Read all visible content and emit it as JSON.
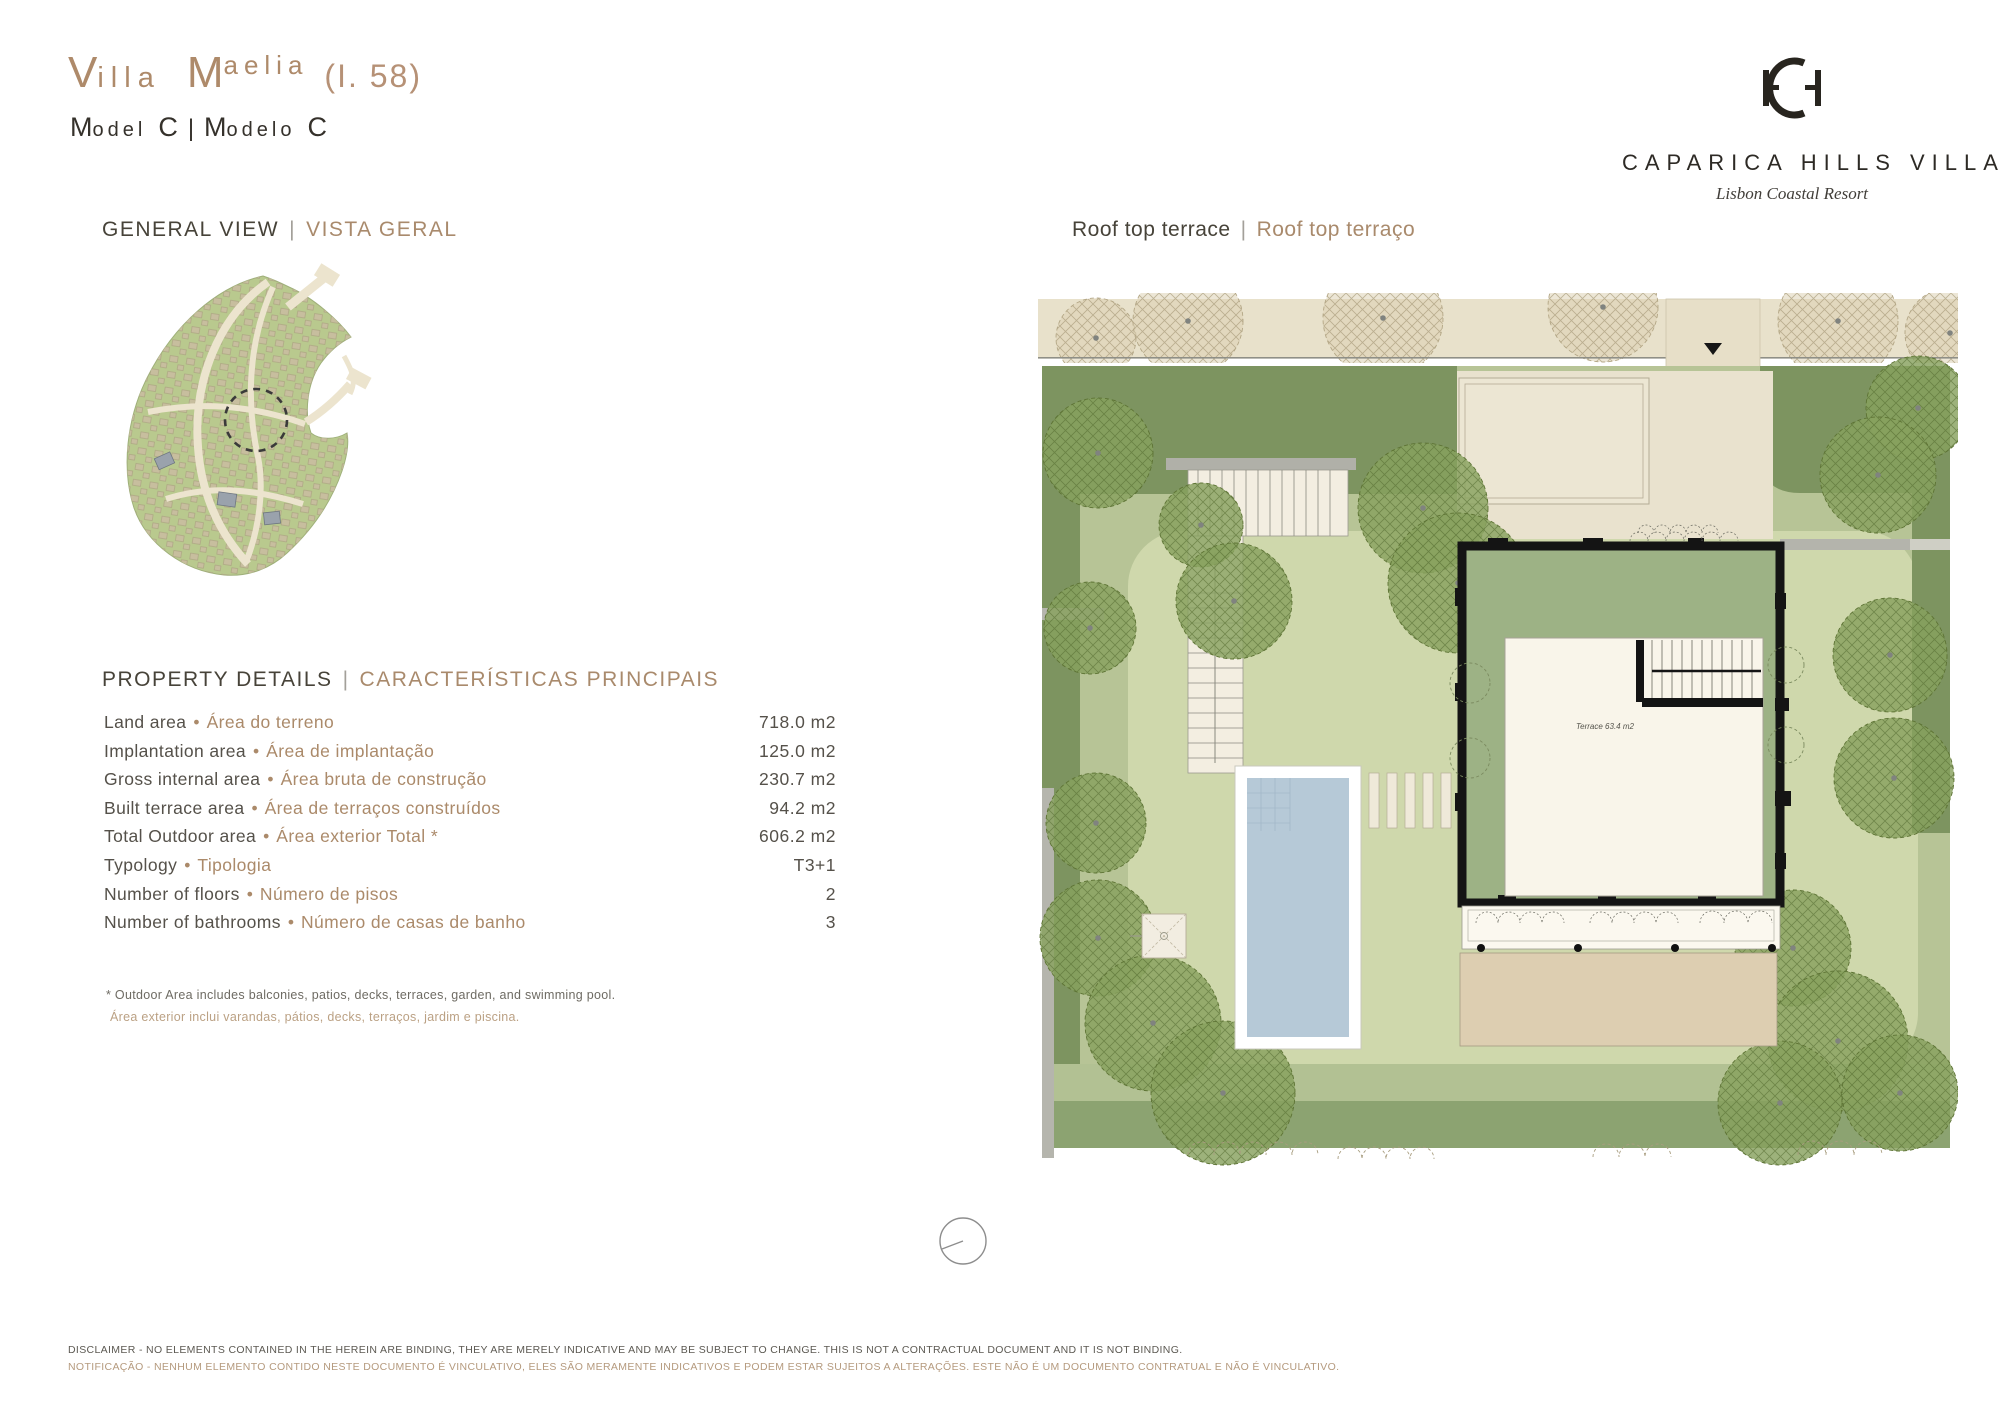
{
  "header": {
    "title_cap1": "V",
    "title_rest1": "illa",
    "title_cap2": "M",
    "title_rest2": "aelia",
    "lot": "(I. 58)",
    "sub": {
      "m1": "M",
      "odel": "odel",
      "c1": "C",
      "pipe": "|",
      "m2": "M",
      "odelo": "odelo",
      "c2": "C"
    }
  },
  "brand": {
    "name": "CAPARICA HILLS VILLAS",
    "tagline": "Lisbon Coastal Resort"
  },
  "sections": {
    "separator": "|",
    "general_view_en": "GENERAL VIEW",
    "general_view_pt": "VISTA GERAL",
    "plan_en": "Roof top terrace",
    "plan_pt": "Roof top terraço"
  },
  "property_details": {
    "heading_en": "PROPERTY DETAILS",
    "heading_pt": "CARACTERÍSTICAS PRINCIPAIS",
    "bullet": "•",
    "rows": [
      {
        "label_en": "Land area",
        "label_pt": "Área do terreno",
        "value": "718.0 m2"
      },
      {
        "label_en": "Implantation area",
        "label_pt": "Área de implantação",
        "value": "125.0 m2"
      },
      {
        "label_en": "Gross internal area",
        "label_pt": "Área bruta de construção",
        "value": "230.7 m2"
      },
      {
        "label_en": "Built terrace area",
        "label_pt": "Área de terraços construídos",
        "value": "94.2 m2"
      },
      {
        "label_en": "Total Outdoor area",
        "label_pt": "Área exterior Total *",
        "value": "606.2 m2"
      },
      {
        "label_en": "Typology",
        "label_pt": "Tipologia",
        "value": "T3+1"
      },
      {
        "label_en": "Number of floors",
        "label_pt": "Número de pisos",
        "value": "2"
      },
      {
        "label_en": "Number of bathrooms",
        "label_pt": "Número de casas de banho",
        "value": "3"
      }
    ],
    "footnote_en": "*  Outdoor Area includes balconies, patios, decks, terraces, garden, and swimming pool.",
    "footnote_pt": "Área exterior inclui varandas, pátios, decks, terraços, jardim e piscina."
  },
  "plan_labels": {
    "terrace": "Terrace 63.4 m2"
  },
  "disclaimer": {
    "line_en": "DISCLAIMER - NO ELEMENTS CONTAINED IN THE HEREIN ARE BINDING, THEY ARE MERELY INDICATIVE AND MAY BE SUBJECT TO CHANGE. THIS IS NOT A CONTRACTUAL DOCUMENT AND IT IS NOT BINDING.",
    "line_pt": "NOTIFICAÇÃO - NENHUM ELEMENTO CONTIDO NESTE DOCUMENTO É VINCULATIVO, ELES SÃO MERAMENTE INDICATIVOS E PODEM ESTAR SUJEITOS A ALTERAÇÕES. ESTE NÃO É UM DOCUMENTO CONTRATUAL E NÃO É VINCULATIVO."
  },
  "colors": {
    "accent_tan": "#ae8a6a",
    "ink": "#35312b",
    "hedge_green": "#7d9460",
    "lawn_green": "#cfd8ac",
    "sage_green": "#b7c496",
    "roof_green": "#9db285",
    "pool_blue": "#b6c9d7",
    "pavement_beige": "#e8e1cb",
    "patio_beige": "#ddceb1",
    "cream": "#f9f5ea"
  }
}
